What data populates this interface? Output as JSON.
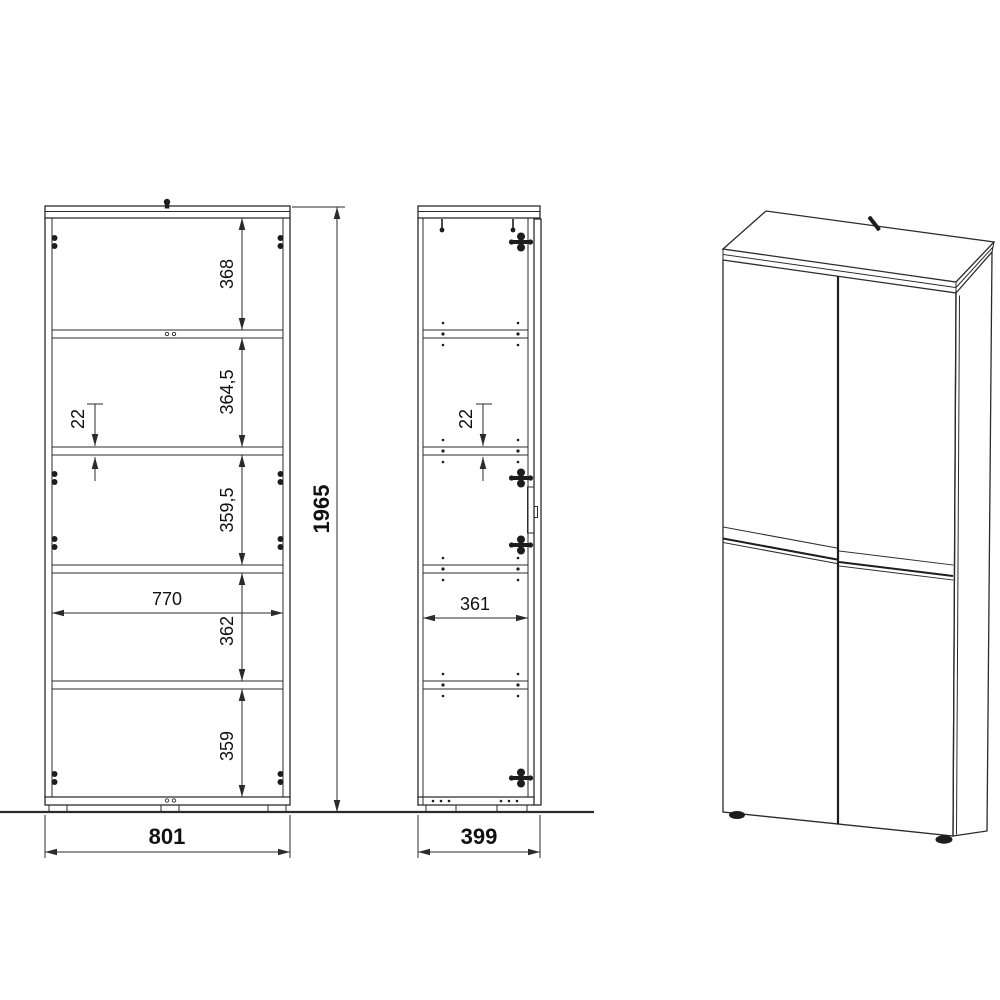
{
  "drawing_title": "cabinet-dimension-drawing",
  "front_view": {
    "overall_height_mm": "1965",
    "overall_width_mm": "801",
    "inner_width_mm": "770",
    "shelf_thickness_mm": "22",
    "compartment_heights_mm": [
      "368",
      "364,5",
      "359,5",
      "362",
      "359"
    ]
  },
  "side_view": {
    "overall_depth_mm": "399",
    "inner_depth_mm": "361",
    "shelf_thickness_mm": "22"
  },
  "colors": {
    "line": "#2b2b2b",
    "text": "#111111",
    "background": "#ffffff"
  }
}
